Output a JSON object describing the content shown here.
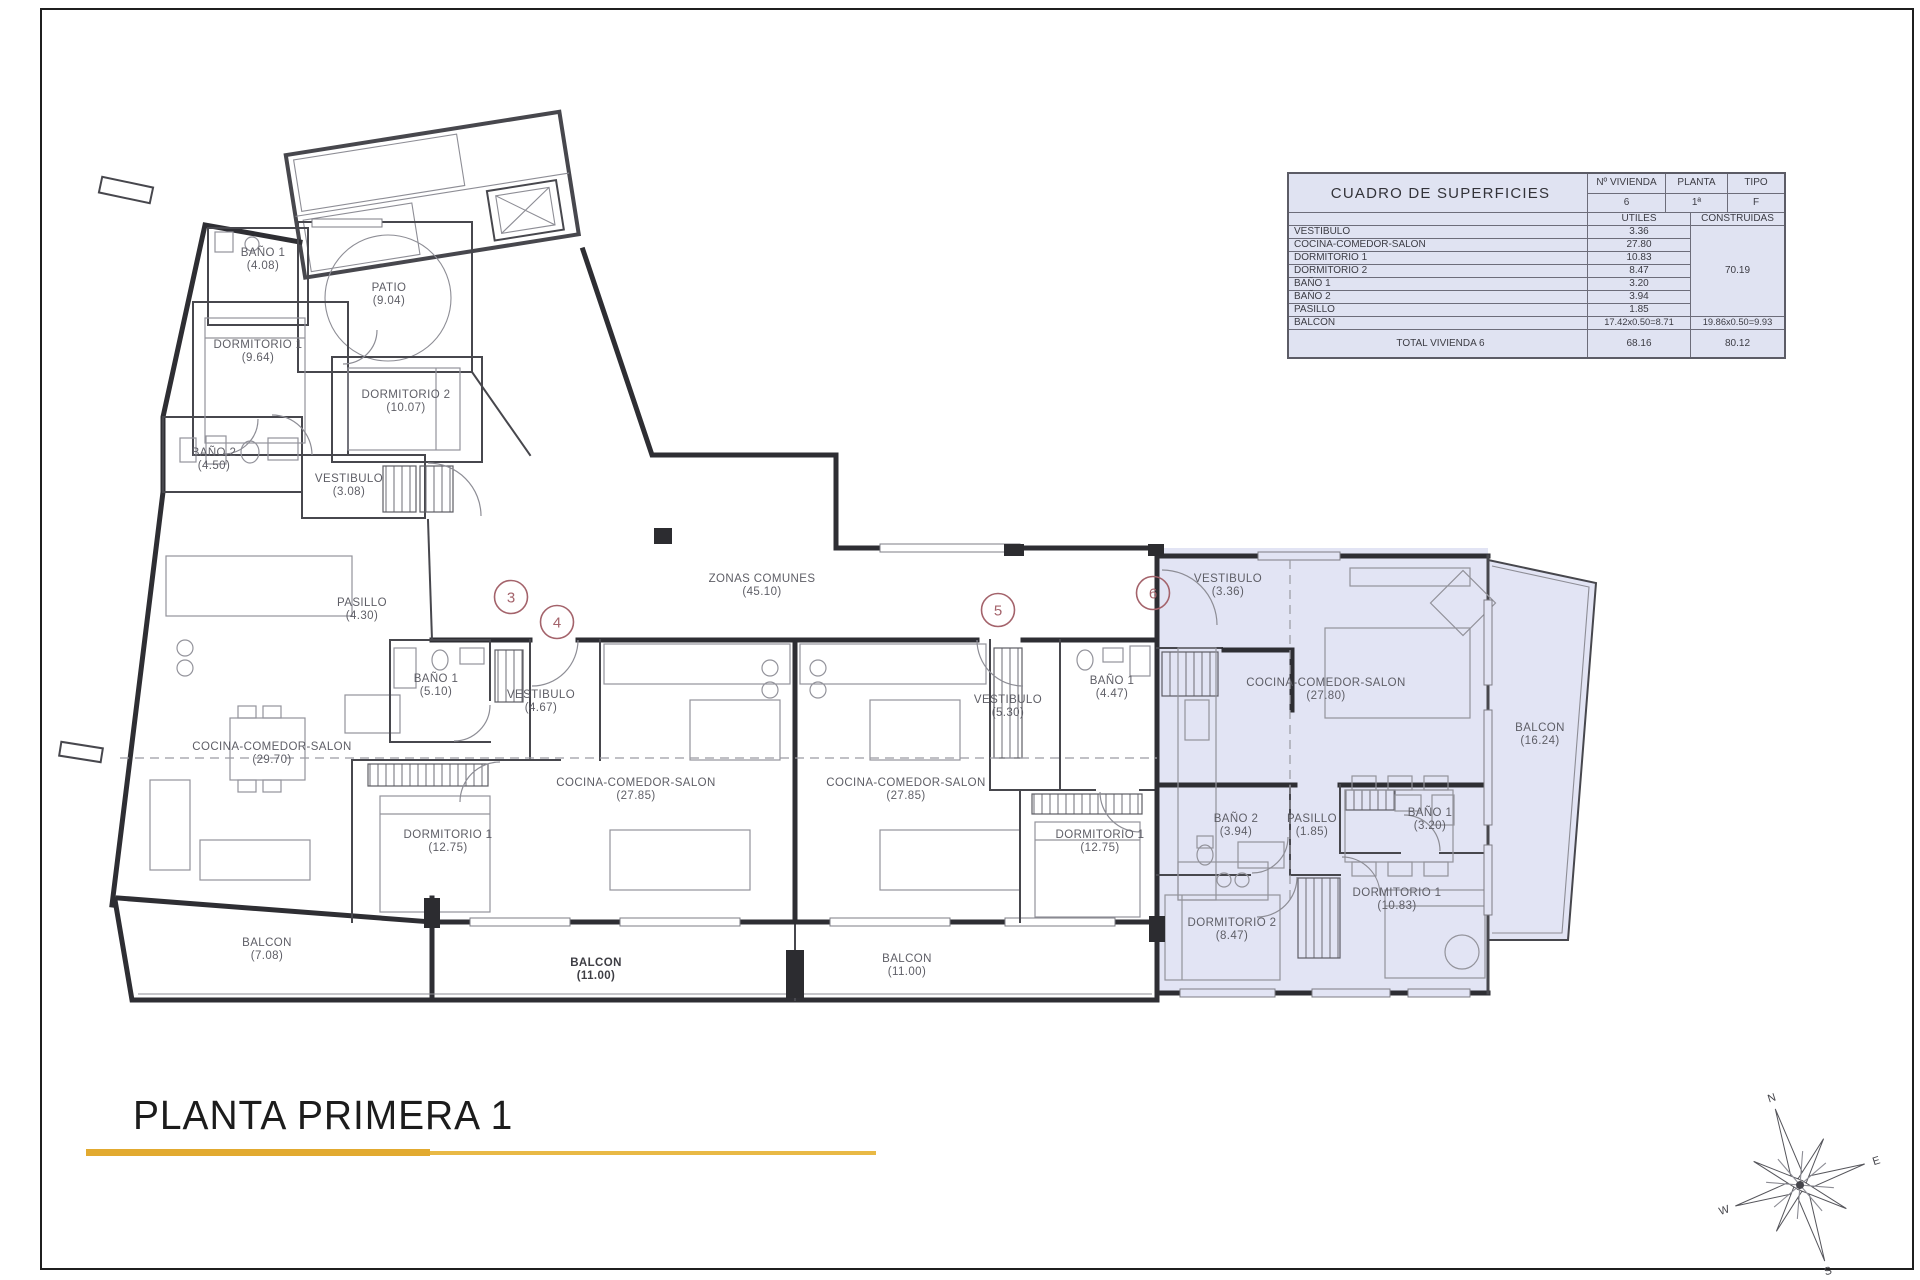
{
  "footer": {
    "title": "PLANTA PRIMERA 1"
  },
  "table": {
    "title": "CUADRO DE SUPERFICIES",
    "col_vivienda": "Nº VIVIENDA",
    "col_planta": "PLANTA",
    "col_tipo": "TIPO",
    "vivienda": "6",
    "planta": "1ª",
    "tipo": "F",
    "col_utiles": "UTILES",
    "col_construidas": "CONSTRUIDAS",
    "rows": [
      {
        "name": "VESTIBULO",
        "utiles": "3.36"
      },
      {
        "name": "COCINA-COMEDOR-SALON",
        "utiles": "27.80"
      },
      {
        "name": "DORMITORIO 1",
        "utiles": "10.83"
      },
      {
        "name": "DORMITORIO 2",
        "utiles": "8.47"
      },
      {
        "name": "BAÑO 1",
        "utiles": "3.20"
      },
      {
        "name": "BAÑO 2",
        "utiles": "3.94"
      },
      {
        "name": "PASILLO",
        "utiles": "1.85"
      }
    ],
    "construidas_partial": "70.19",
    "balcon": {
      "name": "BALCON",
      "utiles": "17.42x0.50=8.71",
      "construidas": "19.86x0.50=9.93"
    },
    "total": {
      "label": "TOTAL VIVIENDA 6",
      "utiles": "68.16",
      "construidas": "80.12"
    }
  },
  "plan": {
    "highlight_color": "#e2e4f4",
    "unit_marker_color": "#a4636b",
    "labels": [
      {
        "name": "BAÑO 1",
        "value": "(4.08)",
        "x": 263,
        "y": 256
      },
      {
        "name": "PATIO",
        "value": "(9.04)",
        "x": 389,
        "y": 291
      },
      {
        "name": "DORMITORIO 1",
        "value": "(9.64)",
        "x": 258,
        "y": 348
      },
      {
        "name": "DORMITORIO 2",
        "value": "(10.07)",
        "x": 406,
        "y": 398
      },
      {
        "name": "BAÑO 2",
        "value": "(4.50)",
        "x": 214,
        "y": 456
      },
      {
        "name": "VESTIBULO",
        "value": "(3.08)",
        "x": 349,
        "y": 482
      },
      {
        "name": "PASILLO",
        "value": "(4.30)",
        "x": 362,
        "y": 606
      },
      {
        "name": "COCINA-COMEDOR-SALON",
        "value": "(29.70)",
        "x": 272,
        "y": 750
      },
      {
        "name": "BAÑO 1",
        "value": "(5.10)",
        "x": 436,
        "y": 682
      },
      {
        "name": "VESTIBULO",
        "value": "(4.67)",
        "x": 541,
        "y": 698
      },
      {
        "name": "DORMITORIO 1",
        "value": "(12.75)",
        "x": 448,
        "y": 838
      },
      {
        "name": "COCINA-COMEDOR-SALON",
        "value": "(27.85)",
        "x": 636,
        "y": 786
      },
      {
        "name": "COCINA-COMEDOR-SALON",
        "value": "(27.85)",
        "x": 906,
        "y": 786
      },
      {
        "name": "VESTIBULO",
        "value": "(5.30)",
        "x": 1008,
        "y": 703
      },
      {
        "name": "BAÑO 1",
        "value": "(4.47)",
        "x": 1112,
        "y": 684
      },
      {
        "name": "DORMITORIO 1",
        "value": "(12.75)",
        "x": 1100,
        "y": 838
      },
      {
        "name": "ZONAS COMUNES",
        "value": "(45.10)",
        "x": 762,
        "y": 582
      },
      {
        "name": "VESTIBULO",
        "value": "(3.36)",
        "x": 1228,
        "y": 582
      },
      {
        "name": "COCINA-COMEDOR-SALON",
        "value": "(27.80)",
        "x": 1326,
        "y": 686
      },
      {
        "name": "BAÑO 2",
        "value": "(3.94)",
        "x": 1236,
        "y": 822
      },
      {
        "name": "PASILLO",
        "value": "(1.85)",
        "x": 1312,
        "y": 822
      },
      {
        "name": "BAÑO 1",
        "value": "(3.20)",
        "x": 1430,
        "y": 816
      },
      {
        "name": "DORMITORIO 2",
        "value": "(8.47)",
        "x": 1232,
        "y": 926
      },
      {
        "name": "DORMITORIO 1",
        "value": "(10.83)",
        "x": 1397,
        "y": 896
      },
      {
        "name": "BALCON",
        "value": "(16.24)",
        "x": 1540,
        "y": 731
      },
      {
        "name": "BALCON",
        "value": "(7.08)",
        "x": 267,
        "y": 946
      },
      {
        "name": "BALCON",
        "value": "(11.00)",
        "x": 596,
        "y": 966,
        "bold": true
      },
      {
        "name": "BALCON",
        "value": "(11.00)",
        "x": 907,
        "y": 962
      }
    ],
    "units": [
      {
        "n": "3",
        "x": 511,
        "y": 597
      },
      {
        "n": "4",
        "x": 557,
        "y": 622
      },
      {
        "n": "5",
        "x": 998,
        "y": 610
      },
      {
        "n": "6",
        "x": 1153,
        "y": 593
      }
    ]
  },
  "compass": {
    "n": "N",
    "e": "E",
    "s": "S",
    "w": "W"
  }
}
